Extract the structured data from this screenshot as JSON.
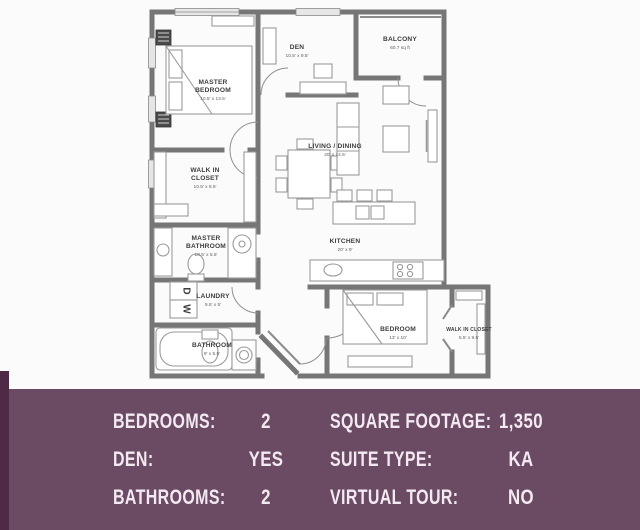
{
  "plan": {
    "rooms": [
      {
        "id": "master-bedroom",
        "lines": [
          "MASTER",
          "BEDROOM"
        ],
        "dims": "10.5' x 13.5'"
      },
      {
        "id": "den",
        "lines": [
          "DEN"
        ],
        "dims": "10.5' x 9.5'"
      },
      {
        "id": "balcony",
        "lines": [
          "BALCONY"
        ],
        "dims": "60.7 sq ft"
      },
      {
        "id": "walk-in-closet",
        "lines": [
          "WALK IN",
          "CLOSET"
        ],
        "dims": "10.5' x 8.5'"
      },
      {
        "id": "master-bathroom",
        "lines": [
          "MASTER",
          "BATHROOM"
        ],
        "dims": "10.5' x 5.5'"
      },
      {
        "id": "laundry",
        "lines": [
          "LAUNDRY"
        ],
        "dims": "9.5' x 5'"
      },
      {
        "id": "bathroom",
        "lines": [
          "BATHROOM"
        ],
        "dims": "9' x 5.5'"
      },
      {
        "id": "living-dining",
        "lines": [
          "LIVING / DINING"
        ],
        "dims": "20' x 14.5'"
      },
      {
        "id": "kitchen",
        "lines": [
          "KITCHEN"
        ],
        "dims": "20' x 9'"
      },
      {
        "id": "bedroom",
        "lines": [
          "BEDROOM"
        ],
        "dims": "13' x 10'"
      },
      {
        "id": "walk-in-closet-2",
        "lines": [
          "WALK IN CLOSET"
        ],
        "dims": "5.5' x 9.5'"
      }
    ],
    "appliances": {
      "washer": "W",
      "dryer": "D"
    }
  },
  "panel": {
    "bg_color": "#6b4a64",
    "accent_color": "#4e2a47",
    "text_color": "#f3eaf1",
    "fields": [
      {
        "label": "BEDROOMS:",
        "value": "2"
      },
      {
        "label": "DEN:",
        "value": "YES"
      },
      {
        "label": "BATHROOMS:",
        "value": "2"
      },
      {
        "label": "SQUARE FOOTAGE:",
        "value": "1,350"
      },
      {
        "label": "SUITE TYPE:",
        "value": "KA"
      },
      {
        "label": "VIRTUAL TOUR:",
        "value": "NO"
      }
    ]
  }
}
